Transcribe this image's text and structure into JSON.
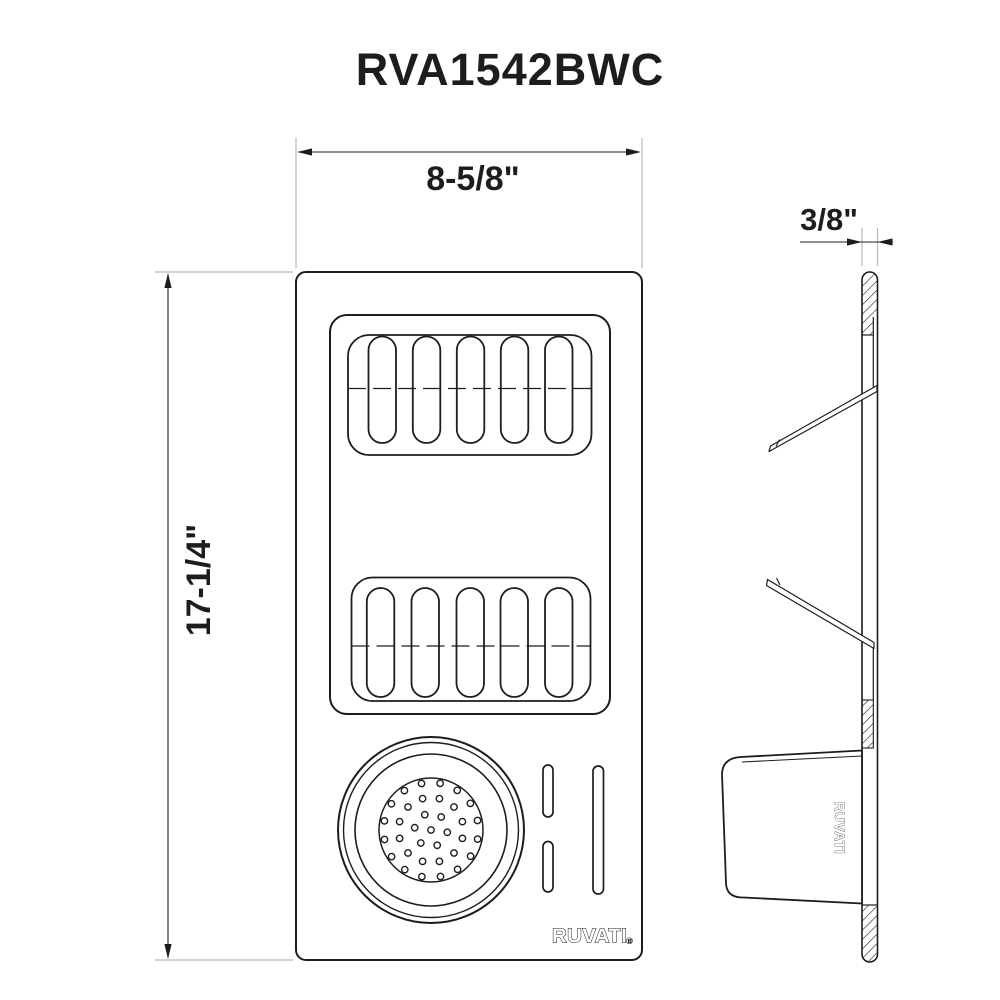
{
  "page_title": "RVA1542BWC",
  "dimensions": {
    "width": "8-5/8\"",
    "height": "17-1/4\"",
    "thickness": "3/8\""
  },
  "branding": {
    "plan_logo": "RUVATI.",
    "registered_mark": "®",
    "side_logo": "RUVATI"
  },
  "colors": {
    "line": "#1d1d1d",
    "extension_line": "#b8b8b8",
    "background": "#ffffff"
  },
  "drawing": {
    "colander": {
      "cx": 431,
      "cy": 830,
      "ring_radii": [
        93,
        87.5,
        76,
        52
      ],
      "ring_strokes": [
        2,
        1.4,
        1.6,
        1.5
      ],
      "hole_radius": 3.2,
      "hole_rings": [
        {
          "r": 0,
          "count": 1,
          "offset": 0
        },
        {
          "r": 16.5,
          "count": 6,
          "offset": 8
        },
        {
          "r": 32.5,
          "count": 12,
          "offset": 15
        },
        {
          "r": 47.5,
          "count": 16,
          "offset": 11
        }
      ]
    }
  }
}
